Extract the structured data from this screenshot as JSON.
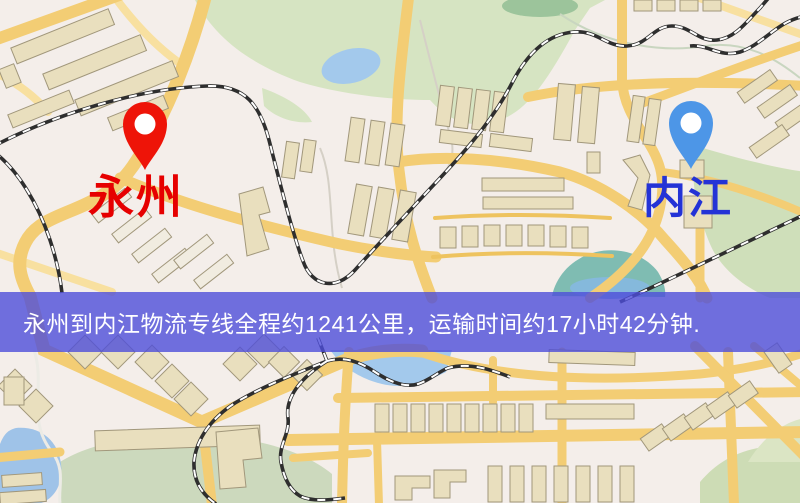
{
  "banner": {
    "text": "永州到内江物流专线全程约1241公里，运输时间约17小时42分钟.",
    "distance": "1241公里",
    "duration": "17小时42分钟"
  },
  "markers": {
    "origin": {
      "label": "永州",
      "pin_icon": "red-location-pin-icon"
    },
    "destination": {
      "label": "内江",
      "pin_icon": "blue-location-pin-icon"
    }
  },
  "palette": {
    "bg": "#f4eeea",
    "park": "#d6e4c2",
    "park-dark": "#9cc49b",
    "field": "#ccd9bd",
    "teal": "#7fbcb2",
    "water": "#a3c9ec",
    "road": "#f3cd74",
    "road-pale": "#f8e0a0",
    "railway": "#2e2e2e",
    "building": "#e9dfbe",
    "building-light": "#f1ece0",
    "building-stroke": "#a1977b",
    "stream": "#d5d0c6",
    "banner-bg": "rgba(77,77,217,0.8)",
    "banner-text": "#ffffff",
    "origin-pin": "#ee1408",
    "origin-label": "#e60000",
    "destination-pin": "#4d96e7",
    "destination-label": "#2433d6"
  }
}
